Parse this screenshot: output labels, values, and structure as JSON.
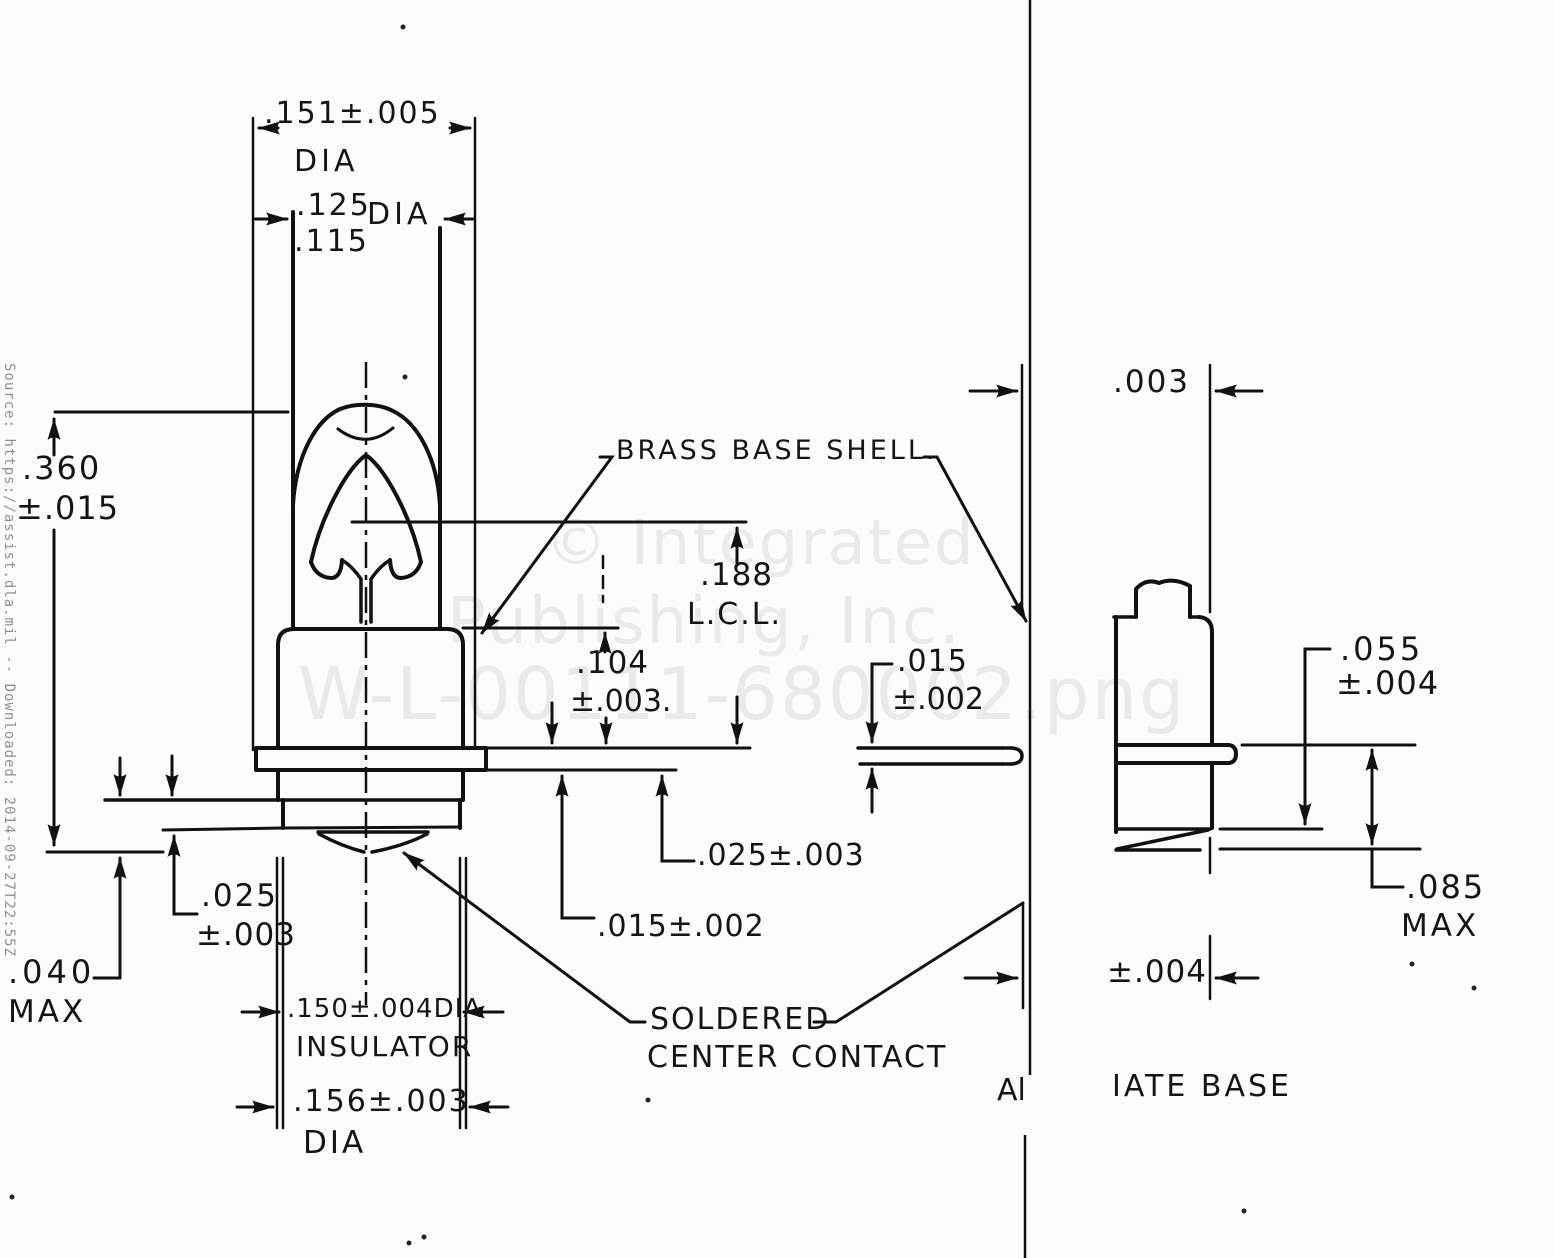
{
  "document": {
    "source_note": "Source: https://assist.dla.mil -- Downloaded: 2014-09-27T22:55Z",
    "watermark_line1": "© Integrated",
    "watermark_line2": "Publishing, Inc.",
    "watermark_line3": "W-L-00111-680002.png"
  },
  "main_view": {
    "shell_dia_value": ".151±.005",
    "shell_dia_unit": "DIA",
    "bulb_dia_max": ".125",
    "bulb_dia_min": ".115",
    "bulb_dia_unit": "DIA",
    "overall_height_value": ".360",
    "overall_height_tol": "±.015",
    "brass_shell_label": "BRASS BASE SHELL.",
    "lcl_value": ".188",
    "lcl_label": "L.C.L.",
    "base_height_value": ".104",
    "base_height_tol": "±.003.",
    "flange_thickness": ".015±.002",
    "flange_to_base": ".025±.003",
    "insulator_step_value": ".025",
    "insulator_step_tol": "±.003",
    "contact_height_value": ".040",
    "contact_height_label": "MAX",
    "insulator_dia": ".150±.004DIA",
    "insulator_label": "INSULATOR",
    "flange_dia_value": ".156±.003",
    "flange_dia_unit": "DIA",
    "contact_label_line1": "SOLDERED",
    "contact_label_line2": "CENTER CONTACT"
  },
  "alt_view": {
    "offset_dim": ".003",
    "flange_thickness_value": ".015",
    "flange_thickness_tol": "±.002",
    "contact_plane_value": ".055",
    "contact_plane_tol": "±.004",
    "overall_max_value": ".085",
    "overall_max_label": "MAX",
    "bottom_dim": "±.004",
    "caption_left": "Al",
    "caption_right": "IATE BASE"
  }
}
